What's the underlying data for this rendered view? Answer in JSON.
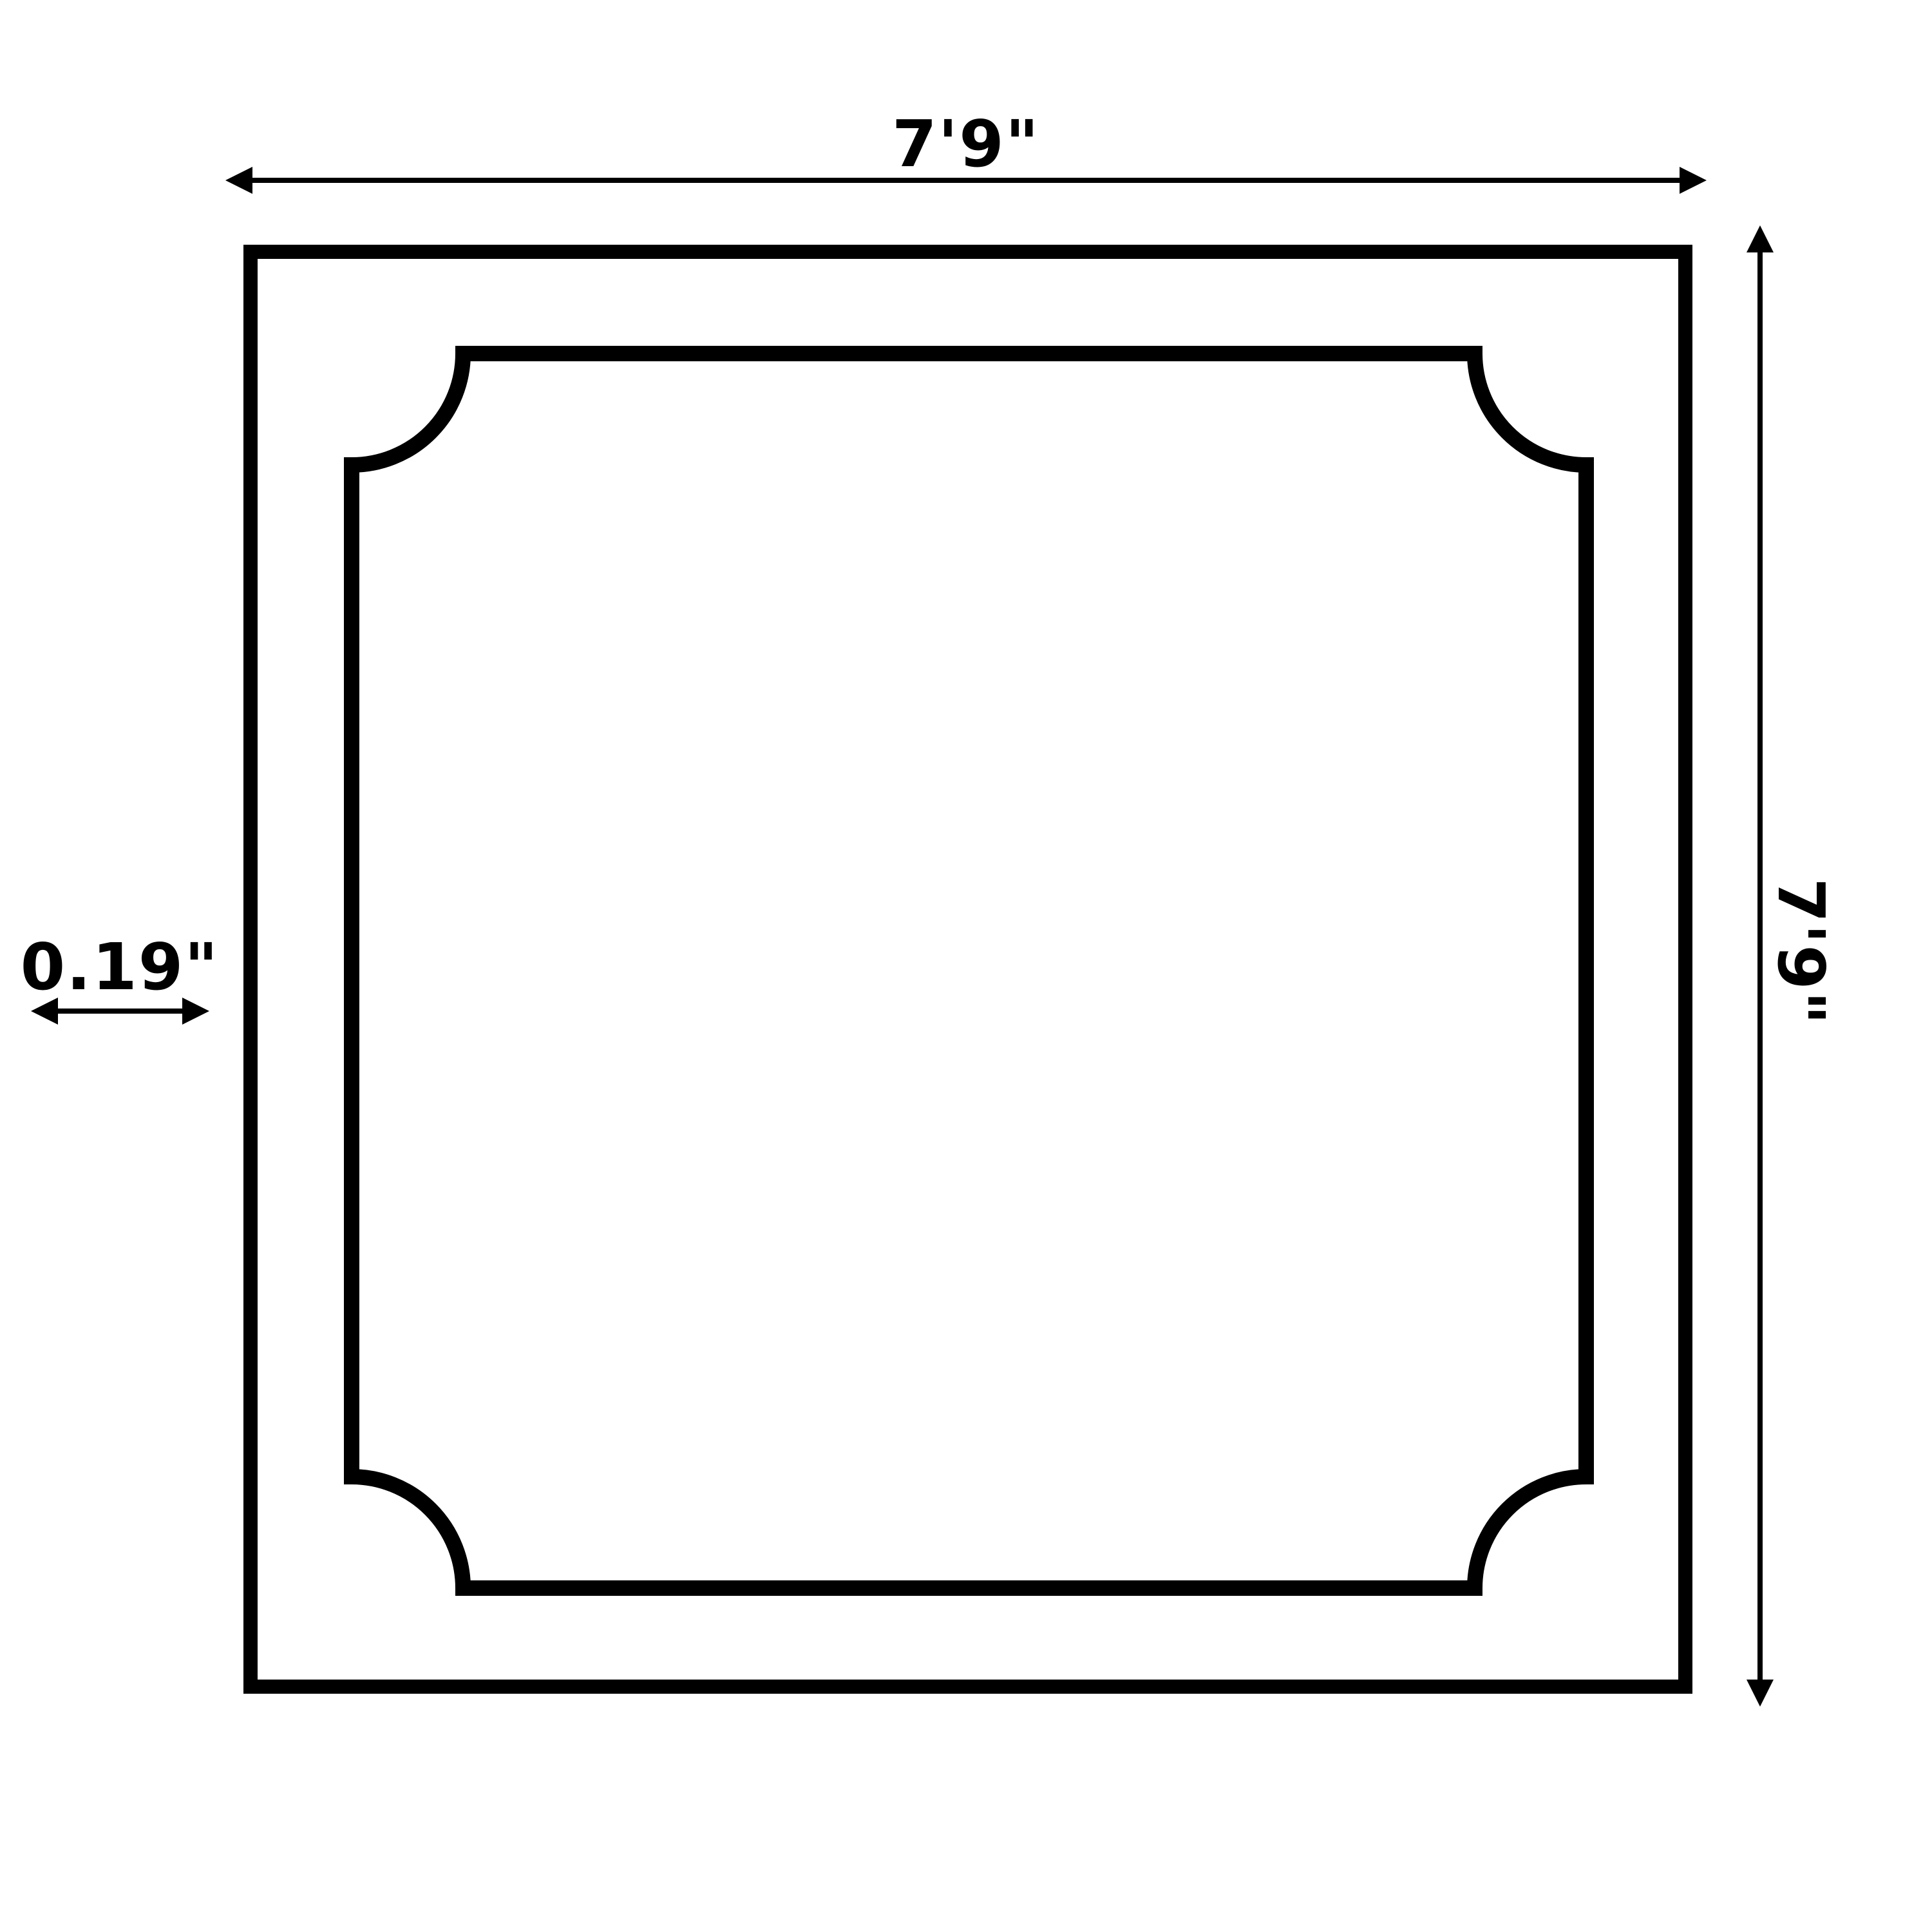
{
  "diagram": {
    "labels": {
      "width": "7'9\"",
      "height": "7'9\"",
      "thickness": "0.19\""
    },
    "colors": {
      "ink": "#000000",
      "background": "#ffffff"
    }
  }
}
